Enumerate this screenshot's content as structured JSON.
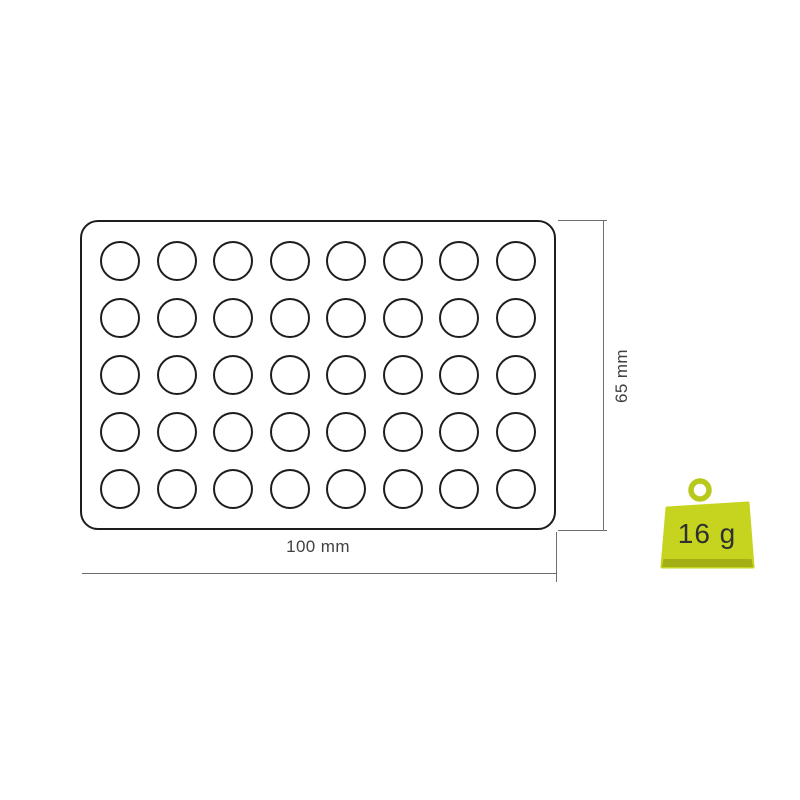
{
  "diagram": {
    "tray": {
      "rows": 5,
      "cols": 8,
      "cavity_count": 40,
      "cavity_shape": "circle"
    },
    "dimensions": {
      "width_label": "100 mm",
      "height_label": "65 mm"
    },
    "weight_badge": {
      "label": "16 g"
    },
    "colors": {
      "outline": "#1d1d1b",
      "dimension_line": "#6d6e71",
      "label_text": "#414042",
      "weight_body": "#c6d41f",
      "weight_band": "#a2b016",
      "weight_ring": "#b9c91c",
      "weight_label": "#2f3130",
      "background": "#ffffff"
    }
  }
}
